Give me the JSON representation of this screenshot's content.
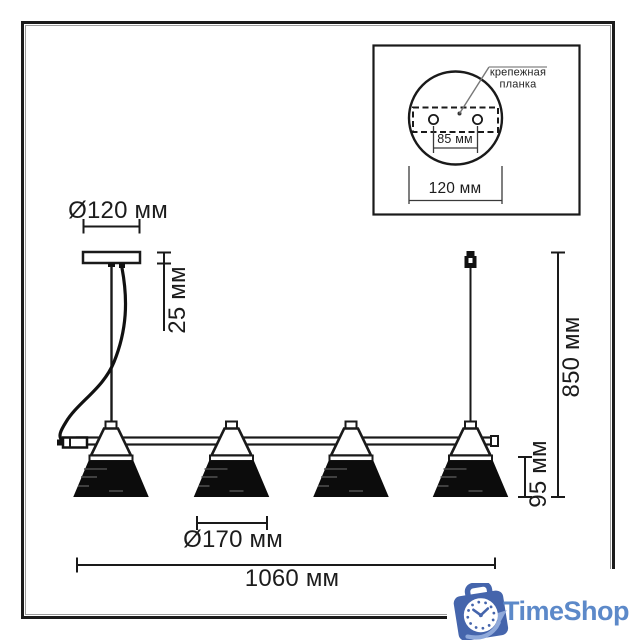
{
  "diagram": {
    "dim_canopy_diameter": "Ø120 мм",
    "dim_canopy_height": "25 мм",
    "dim_total_height": "850 мм",
    "dim_shade_height": "95 мм",
    "dim_shade_diameter": "Ø170 мм",
    "dim_total_length": "1060 мм",
    "inset": {
      "label_line1": "крепежная",
      "label_line2": "планка",
      "dim_hole_spacing": "85 мм",
      "dim_plate_width": "120 мм"
    }
  },
  "branding": {
    "logo_text": "TimeShop",
    "logo_icon": "clock-shopping-bag-icon",
    "logo_bag_color": "#4565ac",
    "logo_swoosh_color": "#8fa9da",
    "logo_text_color": "#5c89c9"
  },
  "colors": {
    "line": "#1a1a1a",
    "background": "#ffffff"
  }
}
